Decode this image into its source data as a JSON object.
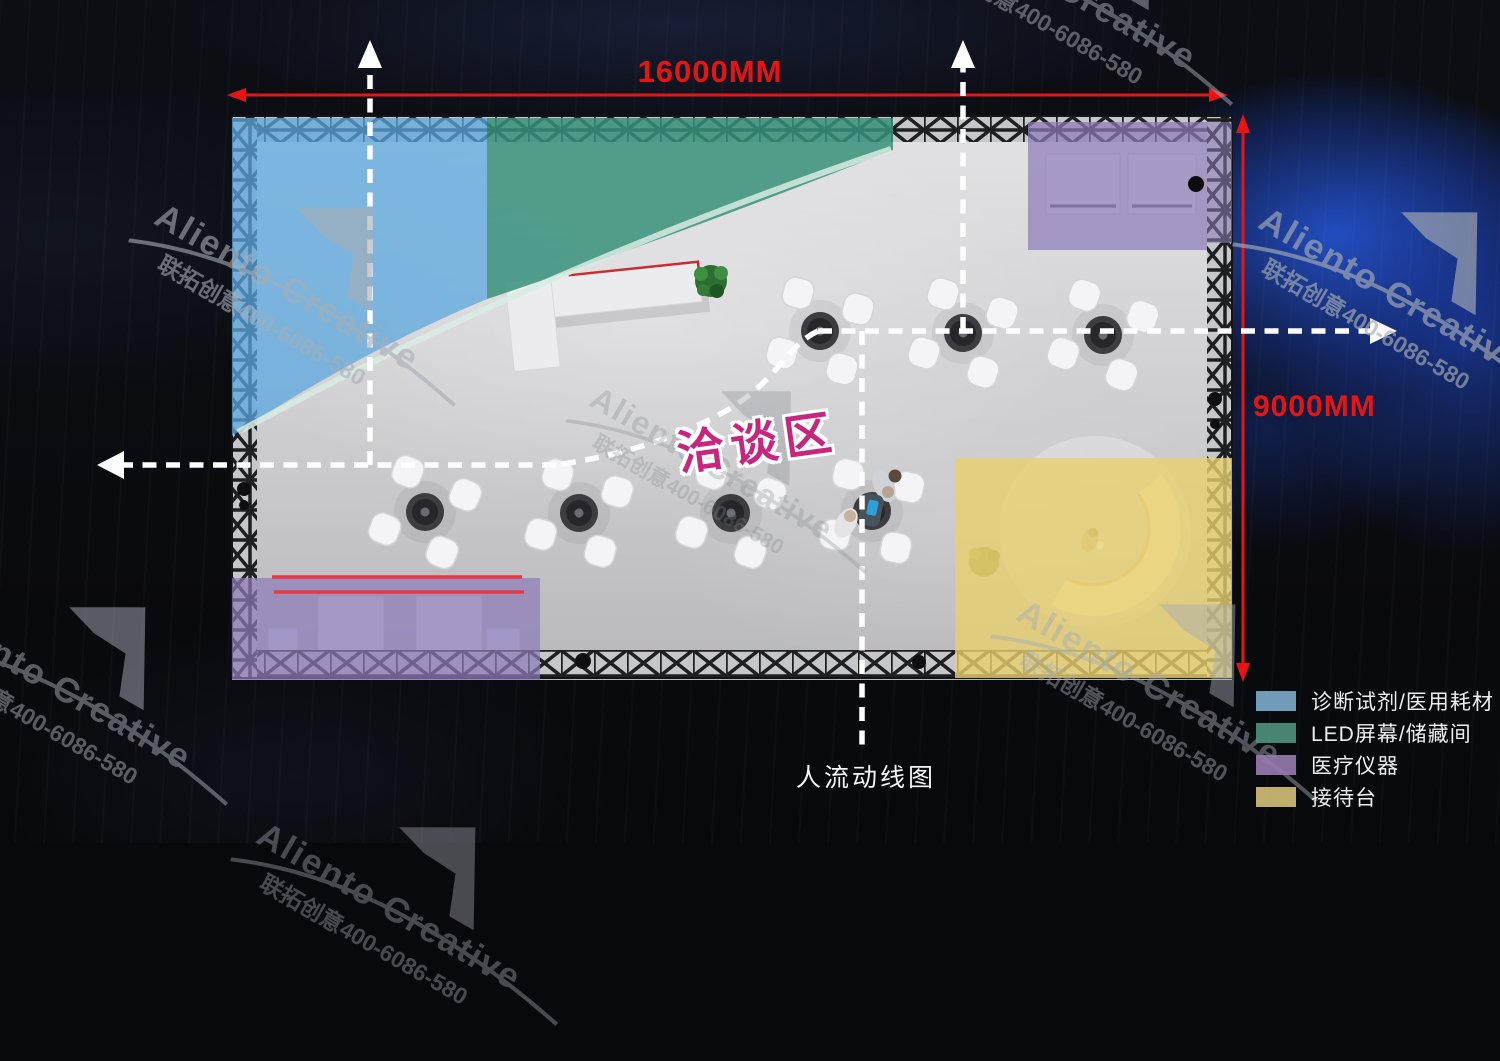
{
  "watermark": {
    "brand": "Aliento Creative",
    "contact": "联拓创意400-6086-580"
  },
  "dimensions": {
    "width_label": "16000MM",
    "height_label": "9000MM",
    "color": "#e81414"
  },
  "labels": {
    "area": "洽谈区",
    "area_color": "#c9257f",
    "flow": "人流动线图",
    "flow_line_color": "#ffffff"
  },
  "zones": {
    "diagnostics": {
      "label": "诊断试剂/医用耗材",
      "color": "#5ba7dd"
    },
    "led_storage": {
      "label": "LED屏幕/储藏间",
      "color": "#37917a"
    },
    "equipment": {
      "label": "医疗仪器",
      "color": "#8d7cb8"
    },
    "reception": {
      "label": "接待台",
      "color": "#e7cf6e"
    }
  },
  "legend": [
    {
      "label": "诊断试剂/医用耗材",
      "color": "#79a9c9"
    },
    {
      "label": "LED屏幕/储藏间",
      "color": "#4d8f7c"
    },
    {
      "label": "医疗仪器",
      "color": "#957aac"
    },
    {
      "label": "接待台",
      "color": "#cfbd75"
    }
  ]
}
